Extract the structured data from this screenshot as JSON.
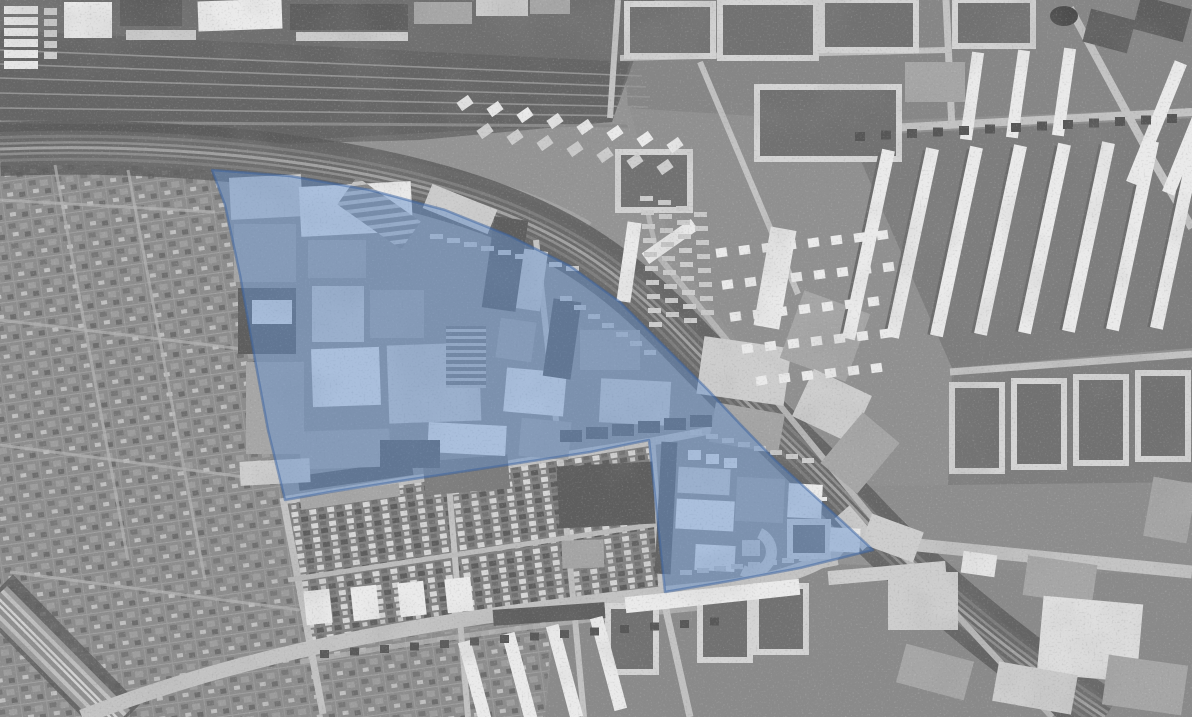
{
  "map": {
    "width": 1192,
    "height": 717,
    "palette": {
      "base": "#949494",
      "W": "#eaeaea",
      "L": "#cdcdcd",
      "M": "#a6a6a6",
      "D": "#5e5e5e",
      "K": "#454545",
      "court": "#717171",
      "ringStroke": "#d4d4d4",
      "road": "#c3c3c3",
      "overlayFill": "rgba(100,145,205,0.48)",
      "overlayStroke": "rgba(58,98,160,0.5)"
    },
    "zones": [
      {
        "name": "ne-residential-base",
        "p": "655,0 1192,0 1192,717 1108,717 1040,648 940,556 868,486 800,418 745,352 700,292 668,232 648,172 630,110 640,40",
        "f": "#909090"
      },
      {
        "name": "top-blocks-zone",
        "p": "620,0 1192,0 1192,108 850,122 628,108",
        "f": "#868686"
      },
      {
        "name": "courtyard-strip-a",
        "p": "850,136 1192,118 1192,348 952,368",
        "f": "#7d7d7d"
      },
      {
        "name": "courtyard-strip-b",
        "p": "952,372 1192,352 1192,482 948,486",
        "f": "#7e7e7e"
      },
      {
        "name": "bottom-right-district",
        "p": "868,486 1192,482 1192,717 1108,717 1040,648 940,556",
        "f": "#8d8d8d"
      },
      {
        "name": "rail-yard",
        "p": "0,0 655,0 612,122 420,140 200,146 0,151",
        "f": "#6f6f6f"
      },
      {
        "name": "rail-yard-inner",
        "p": "0,30 630,62 612,122 300,140 0,148",
        "f": "#656565"
      },
      {
        "name": "allotment-gardens-west",
        "p": "0,152 212,170 225,205 240,275 255,360 268,430 285,500 323,712 300,717 0,717",
        "f": "url(#pat-allot)"
      },
      {
        "name": "allotment-gardens-south",
        "p": "300,717 310,648 480,628 552,616 545,717",
        "f": "url(#pat-allot)"
      },
      {
        "name": "bottom-center-district",
        "p": "545,717 555,614 660,600 836,564 1192,576 1192,717",
        "f": "#8a8a8a"
      },
      {
        "name": "notch-housing",
        "p": "285,500 649,440 665,592 658,600 480,626 310,645",
        "f": "url(#pat-houses)"
      }
    ],
    "yardtracks": [
      {
        "d": "M0,50 L642,76",
        "w": 1.6,
        "c": "#949494"
      },
      {
        "d": "M0,64 L646,87",
        "w": 1.6,
        "c": "#949494"
      },
      {
        "d": "M0,78 L650,97",
        "w": 1.6,
        "c": "#949494"
      },
      {
        "d": "M0,93 L648,107",
        "w": 1.6,
        "c": "#949494"
      },
      {
        "d": "M0,108 L640,116",
        "w": 1.6,
        "c": "#949494"
      },
      {
        "d": "M0,122 L628,126",
        "w": 3,
        "c": "#8a8a8a"
      },
      {
        "d": "M0,135 C300,142 480,160 590,225",
        "w": 6,
        "c": "#a9a9a9",
        "o": 0.75
      }
    ],
    "treeband": [
      {
        "d": "M0,149 C160,143 320,158 440,192 C560,226 620,272 685,340 C750,408 800,452 855,510 C915,575 1010,655 1105,717",
        "w": 54,
        "c": "#5a5a5a",
        "o": 0.8
      },
      {
        "d": "M-5,592 L122,722",
        "w": 50,
        "c": "#5c5c5c",
        "o": 0.8
      }
    ],
    "bands": [
      {
        "name": "main-railway",
        "d": "M0,149 C160,143 320,158 440,192 C560,226 620,272 685,340 C750,408 800,452 855,510 C915,575 1010,655 1105,717",
        "s": [
          [
            34,
            "#686868"
          ],
          [
            26,
            "#7d7d7d"
          ],
          [
            20,
            "#6a6a6a"
          ],
          [
            13,
            "#8e8e8e"
          ],
          [
            8,
            "#6a6a6a"
          ],
          [
            3,
            "#a2a2a2"
          ]
        ]
      },
      {
        "name": "corner-railway",
        "d": "M-5,598 L118,722",
        "s": [
          [
            34,
            "#9a9a9a"
          ],
          [
            24,
            "#c0c0c0"
          ],
          [
            16,
            "#8f8f8f"
          ],
          [
            7,
            "#d2d2d2"
          ],
          [
            2,
            "#8f8f8f"
          ]
        ]
      }
    ],
    "roads": [
      {
        "d": "M82,717 C240,655 420,618 700,590 C760,584 802,574 832,554 L846,538",
        "w": 15
      },
      {
        "d": "M846,538 L1192,572",
        "w": 13
      },
      {
        "d": "M842,512 L870,544",
        "w": 20,
        "c": "#c8c8c8"
      },
      {
        "d": "M300,662 C460,634 600,617 742,604",
        "w": 5,
        "c": "#b2b2b2",
        "o": 0.85
      },
      {
        "d": "M283,498 L323,714",
        "w": 7
      },
      {
        "d": "M285,500 L649,442 L750,423",
        "w": 8
      },
      {
        "d": "M448,473 L468,717",
        "w": 6
      },
      {
        "d": "M536,240 L560,456 L584,717",
        "w": 6
      },
      {
        "d": "M652,444 L662,592 L690,717",
        "w": 7
      },
      {
        "d": "M288,580 L658,524",
        "w": 5,
        "c": "#bcbcbc"
      },
      {
        "d": "M660,598 L838,562",
        "w": 6
      },
      {
        "d": "M660,258 C730,345 800,430 870,515 C940,600 1010,672 1052,717",
        "w": 6,
        "c": "#b6b6b6"
      },
      {
        "d": "M660,258 C648,225 644,196 646,168",
        "w": 5,
        "c": "#b6b6b6"
      },
      {
        "d": "M850,130 L1192,112",
        "w": 8
      },
      {
        "d": "M946,0 L952,128",
        "w": 7
      },
      {
        "d": "M950,372 L1192,354",
        "w": 7
      },
      {
        "d": "M1070,8 L1148,152 L1192,228",
        "w": 8
      },
      {
        "d": "M700,62 L798,294",
        "w": 6
      },
      {
        "d": "M620,58 L946,50",
        "w": 6
      },
      {
        "d": "M618,0 L610,118",
        "w": 6
      },
      {
        "d": "M55,165 L128,560",
        "w": 3,
        "c": "#b5b5b5",
        "o": 0.7
      },
      {
        "d": "M128,170 L205,580",
        "w": 3,
        "c": "#b5b5b5",
        "o": 0.7
      },
      {
        "d": "M0,320 L268,352",
        "w": 3,
        "c": "#b5b5b5",
        "o": 0.7
      },
      {
        "d": "M0,445 L282,482",
        "w": 3,
        "c": "#b5b5b5",
        "o": 0.7
      },
      {
        "d": "M10,572 L300,610",
        "w": 3,
        "c": "#b5b5b5",
        "o": 0.7
      },
      {
        "d": "M0,200 L215,212",
        "w": 3,
        "c": "#b5b5b5",
        "o": 0.7
      }
    ],
    "rings": [
      [
        627,
        4,
        86,
        52
      ],
      [
        720,
        2,
        96,
        56
      ],
      [
        822,
        0,
        94,
        50
      ],
      [
        955,
        0,
        78,
        46
      ],
      [
        757,
        87,
        142,
        72
      ],
      [
        618,
        152,
        72,
        58
      ],
      [
        952,
        385,
        50,
        86
      ],
      [
        1014,
        381,
        50,
        86
      ],
      [
        1076,
        377,
        50,
        86
      ],
      [
        1138,
        373,
        50,
        86
      ],
      [
        790,
        522,
        38,
        34
      ],
      [
        608,
        606,
        48,
        66
      ],
      [
        700,
        594,
        50,
        66
      ],
      [
        756,
        586,
        50,
        66
      ]
    ],
    "blocks": [
      [
        64,
        2,
        48,
        36,
        "W",
        0
      ],
      [
        120,
        0,
        62,
        26,
        "D",
        0
      ],
      [
        126,
        30,
        70,
        10,
        "L",
        0
      ],
      [
        198,
        0,
        84,
        30,
        "W",
        -2
      ],
      [
        290,
        4,
        118,
        26,
        "D",
        0
      ],
      [
        296,
        32,
        112,
        9,
        "L",
        0
      ],
      [
        414,
        2,
        58,
        22,
        "M",
        0
      ],
      [
        476,
        0,
        52,
        16,
        "L",
        0
      ],
      [
        530,
        0,
        40,
        14,
        "M",
        0
      ],
      [
        1086,
        14,
        46,
        34,
        "D",
        15
      ],
      [
        1136,
        2,
        52,
        34,
        "D",
        15
      ],
      [
        905,
        62,
        60,
        40,
        "M",
        0
      ],
      [
        622,
        222,
        14,
        80,
        "W",
        8
      ],
      [
        640,
        235,
        60,
        13,
        "W",
        -35
      ],
      [
        888,
        572,
        70,
        58,
        "L",
        0
      ],
      [
        962,
        553,
        34,
        22,
        "W",
        8
      ],
      [
        1025,
        560,
        70,
        40,
        "M",
        8
      ],
      [
        1040,
        600,
        100,
        78,
        "#dedede",
        5
      ],
      [
        900,
        652,
        70,
        40,
        "M",
        15
      ],
      [
        995,
        668,
        80,
        40,
        "L",
        10
      ],
      [
        1105,
        660,
        80,
        50,
        "M",
        8
      ],
      [
        1148,
        480,
        44,
        60,
        "M",
        10
      ],
      [
        865,
        522,
        55,
        32,
        "L",
        20
      ],
      [
        625,
        588,
        175,
        16,
        "W",
        -6
      ],
      [
        828,
        566,
        118,
        14,
        "L",
        -5
      ],
      [
        493,
        606,
        112,
        16,
        "D",
        -4
      ],
      [
        298,
        468,
        115,
        15,
        "D",
        -8
      ],
      [
        300,
        490,
        100,
        13,
        "M",
        -8
      ],
      [
        424,
        458,
        85,
        34,
        "#7c7c7c",
        -5
      ],
      [
        558,
        464,
        96,
        62,
        "D",
        -3
      ],
      [
        562,
        540,
        42,
        28,
        "M",
        -2
      ],
      [
        230,
        176,
        72,
        42,
        "L",
        -3
      ],
      [
        234,
        224,
        62,
        58,
        "M",
        0
      ],
      [
        300,
        184,
        112,
        50,
        "W",
        -3
      ],
      [
        340,
        196,
        78,
        34,
        "url(#pat-sd)",
        35
      ],
      [
        308,
        240,
        58,
        38,
        "M",
        0
      ],
      [
        425,
        196,
        70,
        26,
        "L",
        22
      ],
      [
        238,
        288,
        58,
        66,
        "D",
        0
      ],
      [
        252,
        300,
        40,
        24,
        "W",
        0
      ],
      [
        312,
        286,
        52,
        56,
        "L",
        0
      ],
      [
        370,
        290,
        54,
        48,
        "M",
        0
      ],
      [
        246,
        362,
        58,
        92,
        "M",
        0
      ],
      [
        312,
        348,
        68,
        58,
        "W",
        -2
      ],
      [
        388,
        344,
        92,
        78,
        "L",
        -2
      ],
      [
        446,
        326,
        40,
        62,
        "url(#pat-sv)",
        0
      ],
      [
        488,
        218,
        34,
        92,
        "D",
        8
      ],
      [
        498,
        320,
        36,
        40,
        "M",
        8
      ],
      [
        520,
        250,
        24,
        60,
        "L",
        8
      ],
      [
        505,
        370,
        60,
        44,
        "W",
        5
      ],
      [
        428,
        424,
        78,
        30,
        "W",
        3
      ],
      [
        300,
        430,
        90,
        38,
        "M",
        -2
      ],
      [
        240,
        460,
        70,
        24,
        "L",
        -3
      ],
      [
        380,
        440,
        60,
        28,
        "D",
        0
      ],
      [
        520,
        420,
        50,
        38,
        "M",
        5
      ],
      [
        548,
        300,
        28,
        78,
        "D",
        8
      ],
      [
        580,
        330,
        60,
        40,
        "M",
        0
      ],
      [
        600,
        380,
        70,
        44,
        "L",
        3
      ],
      [
        700,
        342,
        88,
        58,
        "L",
        8
      ],
      [
        712,
        408,
        70,
        40,
        "M",
        10
      ],
      [
        762,
        228,
        26,
        100,
        "W",
        10
      ],
      [
        790,
        300,
        70,
        72,
        "M",
        20
      ],
      [
        800,
        380,
        64,
        52,
        "L",
        25
      ],
      [
        836,
        420,
        48,
        66,
        "M",
        40
      ],
      [
        658,
        442,
        16,
        132,
        "D",
        3
      ],
      [
        678,
        468,
        52,
        26,
        "L",
        3
      ],
      [
        676,
        500,
        58,
        30,
        "W",
        3
      ],
      [
        736,
        478,
        48,
        44,
        "M",
        3
      ],
      [
        788,
        484,
        34,
        34,
        "W",
        3
      ],
      [
        830,
        528,
        30,
        24,
        "W",
        3
      ],
      [
        695,
        545,
        40,
        26,
        "W",
        3
      ],
      [
        742,
        540,
        18,
        16,
        "L",
        0
      ]
    ],
    "rows": [
      {
        "x": 4,
        "y": 6,
        "dx": 0,
        "dy": 11,
        "n": 6,
        "w": 34,
        "h": 8,
        "f": "W"
      },
      {
        "x": 44,
        "y": 8,
        "dx": 0,
        "dy": 11,
        "n": 5,
        "w": 13,
        "h": 7,
        "f": "L"
      },
      {
        "x": 859,
        "y": 150,
        "dx": 44,
        "dy": -1.5,
        "n": 8,
        "w": 5,
        "h": 190,
        "f": "#6b6b6b",
        "rot": 12
      },
      {
        "x": 862,
        "y": 148,
        "dx": 44,
        "dy": -1.5,
        "n": 8,
        "w": 13,
        "h": 193,
        "f": "W",
        "rot": 12
      },
      {
        "x": 966,
        "y": 52,
        "dx": 46,
        "dy": -2,
        "n": 3,
        "w": 12,
        "h": 88,
        "f": "W",
        "rot": 8
      },
      {
        "x": 1150,
        "y": 58,
        "dx": 36,
        "dy": 10,
        "n": 2,
        "w": 13,
        "h": 130,
        "f": "W",
        "rot": 22
      },
      {
        "x": 470,
        "y": 640,
        "dx": 44,
        "dy": -8,
        "n": 4,
        "w": 13,
        "h": 95,
        "f": "W",
        "rot": -15
      },
      {
        "x": 305,
        "y": 590,
        "dx": 47,
        "dy": -4,
        "n": 4,
        "w": 26,
        "h": 34,
        "f": "W",
        "rot": -6
      },
      {
        "x": 458,
        "y": 98,
        "dx": 30,
        "dy": 6,
        "n": 8,
        "w": 14,
        "h": 10,
        "f": "W",
        "rot": -35
      },
      {
        "x": 478,
        "y": 126,
        "dx": 30,
        "dy": 6,
        "n": 7,
        "w": 14,
        "h": 10,
        "f": "L",
        "rot": -35
      },
      {
        "x": 716,
        "y": 248,
        "dx": 23,
        "dy": -2.5,
        "n": 8,
        "w": 11,
        "h": 9,
        "f": "W",
        "rot": -8
      },
      {
        "x": 722,
        "y": 280,
        "dx": 23,
        "dy": -2.5,
        "n": 8,
        "w": 11,
        "h": 9,
        "f": "W",
        "rot": -8
      },
      {
        "x": 730,
        "y": 312,
        "dx": 23,
        "dy": -2.5,
        "n": 7,
        "w": 11,
        "h": 9,
        "f": "W",
        "rot": -8
      },
      {
        "x": 742,
        "y": 344,
        "dx": 23,
        "dy": -2.5,
        "n": 7,
        "w": 11,
        "h": 9,
        "f": "W",
        "rot": -8
      },
      {
        "x": 756,
        "y": 376,
        "dx": 23,
        "dy": -2.5,
        "n": 6,
        "w": 11,
        "h": 9,
        "f": "W",
        "rot": -8
      },
      {
        "x": 640,
        "y": 196,
        "dx": 1,
        "dy": 14,
        "n": 10,
        "w": 13,
        "h": 5,
        "f": "L"
      },
      {
        "x": 658,
        "y": 200,
        "dx": 1,
        "dy": 14,
        "n": 9,
        "w": 13,
        "h": 5,
        "f": "#c9c9c9"
      },
      {
        "x": 676,
        "y": 206,
        "dx": 1,
        "dy": 14,
        "n": 9,
        "w": 13,
        "h": 5,
        "f": "L"
      },
      {
        "x": 694,
        "y": 212,
        "dx": 1,
        "dy": 14,
        "n": 8,
        "w": 13,
        "h": 5,
        "f": "#c9c9c9"
      },
      {
        "x": 430,
        "y": 234,
        "dx": 17,
        "dy": 4,
        "n": 9,
        "w": 13,
        "h": 5,
        "f": "L"
      },
      {
        "x": 560,
        "y": 296,
        "dx": 14,
        "dy": 9,
        "n": 7,
        "w": 12,
        "h": 5,
        "f": "#c9c9c9"
      },
      {
        "x": 690,
        "y": 430,
        "dx": 16,
        "dy": 4,
        "n": 8,
        "w": 12,
        "h": 5,
        "f": "L"
      },
      {
        "x": 688,
        "y": 450,
        "dx": 18,
        "dy": 4,
        "n": 3,
        "w": 13,
        "h": 10,
        "f": "W"
      },
      {
        "x": 560,
        "y": 430,
        "dx": 26,
        "dy": -3,
        "n": 6,
        "w": 22,
        "h": 12,
        "f": "D"
      },
      {
        "x": 795,
        "y": 488,
        "dx": 9,
        "dy": 3,
        "n": 4,
        "w": 5,
        "h": 4,
        "f": "W"
      },
      {
        "x": 680,
        "y": 570,
        "dx": 17,
        "dy": -2,
        "n": 8,
        "w": 12,
        "h": 5,
        "f": "L"
      },
      {
        "x": 855,
        "y": 132,
        "dx": 26,
        "dy": -1.5,
        "n": 13,
        "w": 10,
        "h": 9,
        "f": "#565656"
      },
      {
        "x": 320,
        "y": 650,
        "dx": 30,
        "dy": -2.5,
        "n": 14,
        "w": 9,
        "h": 8,
        "f": "#585858"
      }
    ],
    "specials": [
      {
        "type": "ellipse",
        "cx": 1064,
        "cy": 16,
        "rx": 14,
        "ry": 10,
        "f": "#4a4a4a"
      },
      {
        "type": "path",
        "d": "M734,566 a26,26 0 1 1 52,0 l-11,0 a15,15 0 1 0 -30,0 z",
        "f": "L",
        "rot": 115,
        "cx": 760,
        "cy": 556
      }
    ],
    "overlay": {
      "name": "highlighted-district",
      "points": "212,170 290,176 370,190 445,210 510,236 570,266 620,302 668,350 708,390 740,424 775,460 810,492 843,522 873,550 800,568 730,581 665,592 657,515 649,440 590,452 500,466 400,481 330,492 285,500 268,430 255,360 240,275 225,205"
    }
  }
}
